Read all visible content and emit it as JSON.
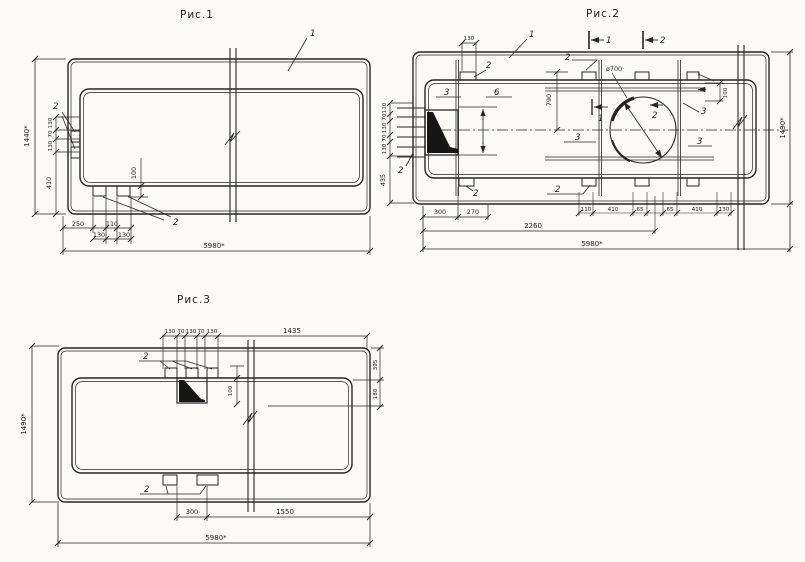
{
  "figures": {
    "fig1": {
      "title": "Рис.1",
      "callout_panel": "1",
      "callout_embeds_left": "2",
      "callout_embeds_bottom": "2",
      "dim_height": "1440*",
      "dim_width": "5980*",
      "left_stack": [
        "130",
        "70",
        "130"
      ],
      "dim_edge_bottom": "410",
      "dim_embed_depth": "100",
      "bottom_dims_upper": [
        "250",
        "110"
      ],
      "bottom_dims_lower": [
        "130",
        "130"
      ]
    },
    "fig2": {
      "title": "Рис.2",
      "callout_panel": "1",
      "section_marks_top": [
        "1",
        "2"
      ],
      "section_marks_mid": [
        "1",
        "2"
      ],
      "callout_embed_top_left": "2",
      "callout_embed_top_mid": "2",
      "callout_embed_bottom_left": "2",
      "callout_embed_bottom_mid": "2",
      "callout_loops_left": "2",
      "callout_rebar": [
        "3",
        "3",
        "3",
        "3"
      ],
      "callout_frame": "6",
      "dim_hole_dia": "ø700",
      "dim_height": "1490*",
      "dim_width": "5980*",
      "dim_top_offset": "130",
      "dim_hole_center": "790",
      "dim_rebar_offset": "100",
      "left_stack": [
        "110",
        "70",
        "130",
        "70",
        "130"
      ],
      "dim_edge_bottom": "435",
      "dim_bottom_left": [
        "300",
        "270"
      ],
      "bottom_dims": [
        "110",
        "410",
        "65",
        "65",
        "410",
        "130"
      ],
      "dim_span": "2260"
    },
    "fig3": {
      "title": "Рис.3",
      "callout_embeds_top": "2",
      "callout_embeds_bottom": "2",
      "dim_height": "1490*",
      "dim_width": "5980*",
      "top_stack": [
        "130",
        "70",
        "130",
        "70",
        "130"
      ],
      "dim_1435": "1435",
      "dim_395": "395",
      "dim_180": "180",
      "dim_embed_depth": "100",
      "dim_300": "300",
      "dim_1550": "1550"
    }
  }
}
